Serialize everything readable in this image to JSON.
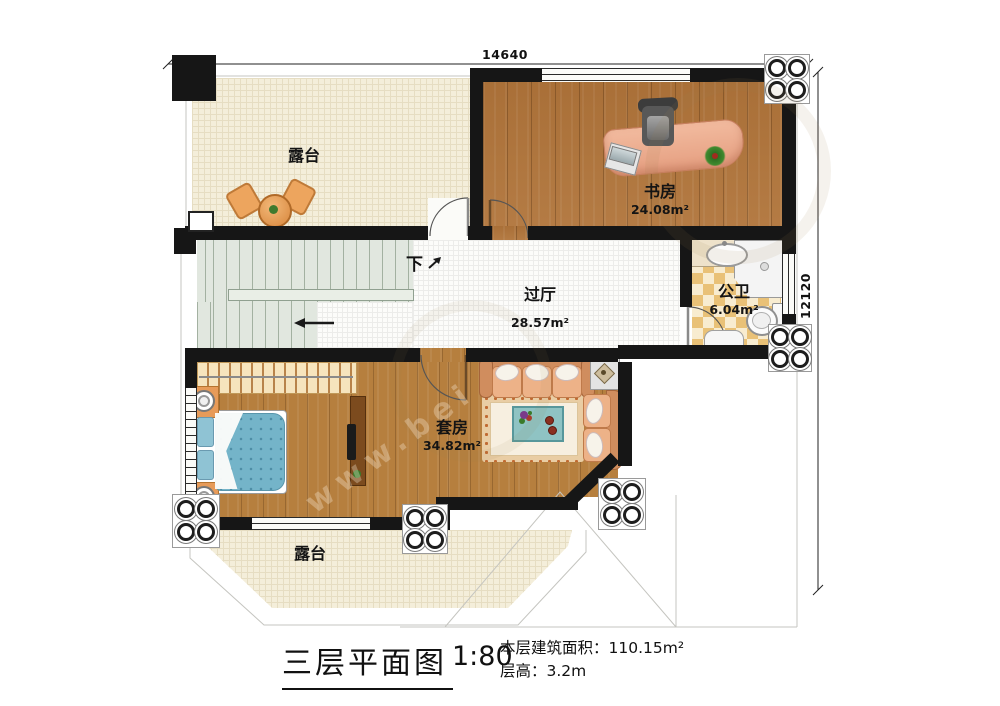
{
  "title": {
    "text": "三层平面图",
    "scale": "1:80"
  },
  "info": {
    "area_label": "本层建筑面积：",
    "area_value": "110.15m²",
    "height_label": "层高：",
    "height_value": "3.2m"
  },
  "dimensions": {
    "width": "14640",
    "height": "12120"
  },
  "rooms": {
    "terrace_top": {
      "name": "露台"
    },
    "study": {
      "name": "书房",
      "area": "24.08m²"
    },
    "bathroom": {
      "name": "公卫",
      "area": "6.04m²"
    },
    "hallway": {
      "name": "过厅",
      "area": "28.57m²"
    },
    "suite": {
      "name": "套房",
      "area": "34.82m²"
    },
    "terrace_bottom": {
      "name": "露台"
    }
  },
  "stairs": {
    "direction_label": "下"
  },
  "watermark": {
    "text": "www.bei"
  },
  "colors": {
    "wall": "#161616",
    "wood": "#b0743a",
    "terrace": "#f4eeda",
    "tile_dark": "#e9c177",
    "tile_light": "#f8ecd0",
    "stair": "#e1e7df",
    "furniture_orange": "#e79b59",
    "bed_blue": "#74b4c9",
    "desk_salmon": "#edb092"
  }
}
